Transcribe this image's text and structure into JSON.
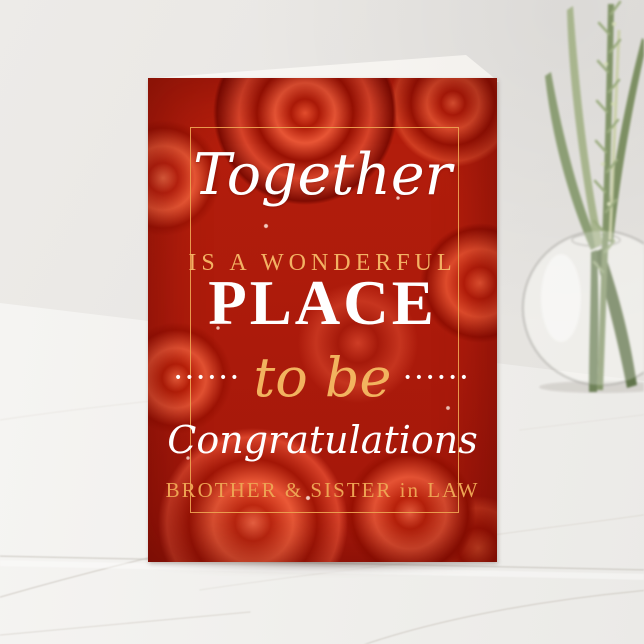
{
  "scene": {
    "description": "Red rose greeting card standing upright on a white marble surface against a light gray wall, with a round glass vase holding green grass stems at the right edge",
    "wall_color": "#e8e6e3",
    "marble_color": "#f2f1ee",
    "marble_vein_color": "#c9c3bb"
  },
  "card": {
    "type": "folded greeting card, front cover shown, white inner page visible at top",
    "background_motif": "red roses",
    "base_color": "#b51e0c",
    "frame_color": "#eca050",
    "text_color_white": "#ffffff",
    "text_color_gold": "#f2b35f",
    "lines": {
      "together": "Together",
      "wonderful": "IS A WONDERFUL",
      "place": "PLACE",
      "dots_left": "••••••",
      "to_be": "to be",
      "dots_right": "••••••",
      "congratulations": "Congratulations",
      "recipient": "BROTHER & SISTER in LAW"
    }
  },
  "props": {
    "vase": "round clear glass bud vase",
    "plant": "green grass blades with wheat-like seed spike"
  }
}
